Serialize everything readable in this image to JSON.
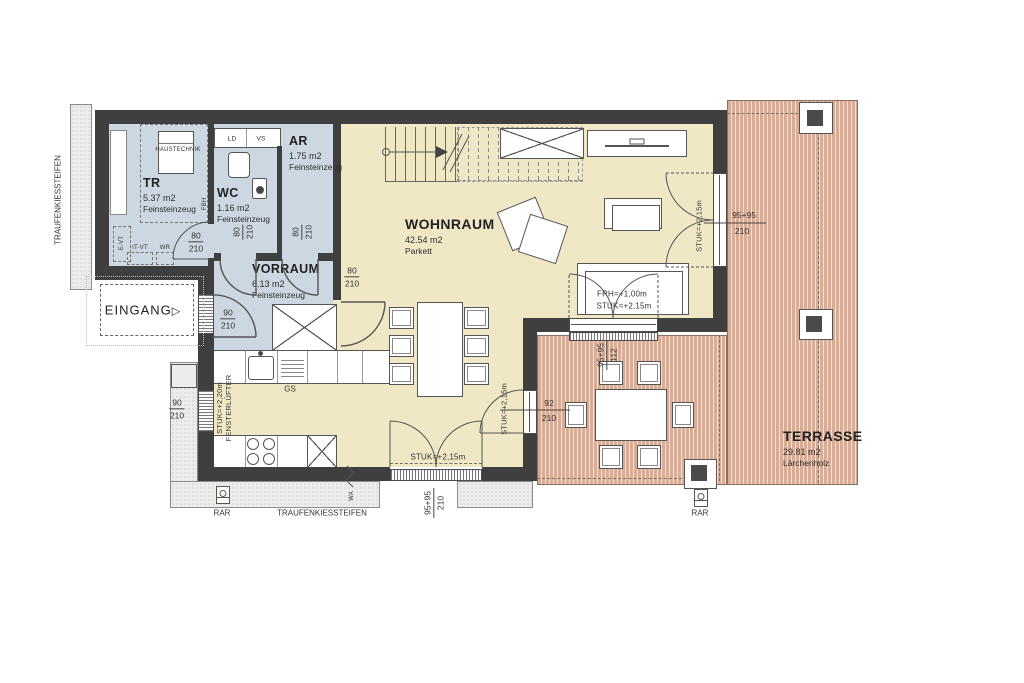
{
  "labels": {
    "eingang": "EINGANG",
    "traufen_left": "TRAUFENKIESSTEIFEN",
    "traufen_bottom": "TRAUFENKIESSTEIFEN",
    "rar_left": "RAR",
    "rar_right": "RAR"
  },
  "icons": {
    "eingang_arrow": "▷"
  },
  "rooms": {
    "tr": {
      "name": "TR",
      "area": "5.37 m2",
      "floor": "Feinsteinzeug"
    },
    "wc": {
      "name": "WC",
      "area": "1.16 m2",
      "floor": "Feinsteinzeug"
    },
    "ar": {
      "name": "AR",
      "area": "1.75 m2",
      "floor": "Feinsteinzeug"
    },
    "vorraum": {
      "name": "VORRAUM",
      "area": "6.13 m2",
      "floor": "Feinsteinzeug"
    },
    "wohnraum": {
      "name": "WOHNRAUM",
      "area": "42.54 m2",
      "floor": "Parkett"
    },
    "terrasse": {
      "name": "TERRASSE",
      "area": "29.81 m2",
      "floor": "Lärchenholz"
    }
  },
  "equipment": {
    "haustechnik": "HAUSTECHNIK",
    "ld": "LD",
    "vs": "VS",
    "fbh": "FBH",
    "e_vt": "E-VT",
    "it_vt": "IT-VT",
    "wr": "WR",
    "gs": "GS",
    "wa": "WA"
  },
  "dims": {
    "tr_door": {
      "num": "80",
      "den": "210"
    },
    "wc_door": {
      "num": "80",
      "den": "210"
    },
    "ar_door": {
      "num": "80",
      "den": "210"
    },
    "vorraum_door": {
      "num": "80",
      "den": "210"
    },
    "entry_door": {
      "num": "90",
      "den": "210"
    },
    "left_window": {
      "num": "90",
      "den": "210"
    },
    "french_door": {
      "num": "95+95",
      "den": "210"
    },
    "terrace_door": {
      "num": "92",
      "den": "210"
    },
    "right_window": {
      "num": "95+95",
      "den": "210"
    },
    "sofa_window": {
      "num": "95+95",
      "den": "112"
    }
  },
  "annotations": {
    "stuk220": "STUK=+2,20m",
    "fensterluefter": "FENSTERLÜFTER",
    "stuk215_french": "STUK=+2,15m",
    "stuk215_terracedoor": "STUK=+2,15m",
    "stuk215_right": "STUK=+2,15m",
    "frh100": "FRH=+1,00m",
    "stuk215_sofa": "STUK=+2,15m"
  },
  "colors": {
    "wall": "#3f3f3f",
    "wet_rooms": "#ccd7e1",
    "living": "#f0e7c5",
    "terrace": "#d8ad98",
    "gravel": "#ececea"
  }
}
